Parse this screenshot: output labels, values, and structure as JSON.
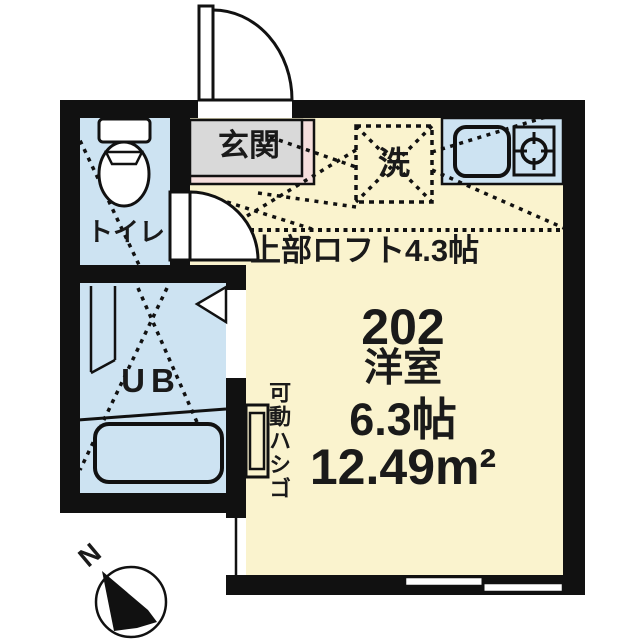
{
  "plan": {
    "entrance_label": "玄関",
    "toilet_label": "トイレ",
    "bath_label": "UB",
    "washer_label": "洗",
    "loft_label": "上部ロフト4.3帖",
    "ladder_label": "可動ハシゴ",
    "unit_number": "202",
    "room_type": "洋室",
    "room_size": "6.3帖",
    "room_area": "12.49m²",
    "compass_label": "N"
  },
  "colors": {
    "wall": "#111111",
    "line": "#111111",
    "floor": "#FAF3CE",
    "wet_area": "#CDE3F2",
    "entrance_gray": "#D9D9D9",
    "entrance_step_pink": "#F5DEDC",
    "white": "#FFFFFF"
  },
  "icons": {
    "north_arrow": "circle-with-black-needle-pointing-NW",
    "toilet": "tank-rect-and-bowl-ellipse",
    "bathtub": "rounded-rect",
    "kitchen_sink": "rounded-rect",
    "stove_burner": "circle-with-four-ticks",
    "entrance_door": "quarter-arc-swing",
    "toilet_door": "quarter-arc-swing",
    "bath_door": "triangle-fold",
    "washer_slot": "dashed-square-with-X",
    "loft_extent": "dotted-lines"
  }
}
